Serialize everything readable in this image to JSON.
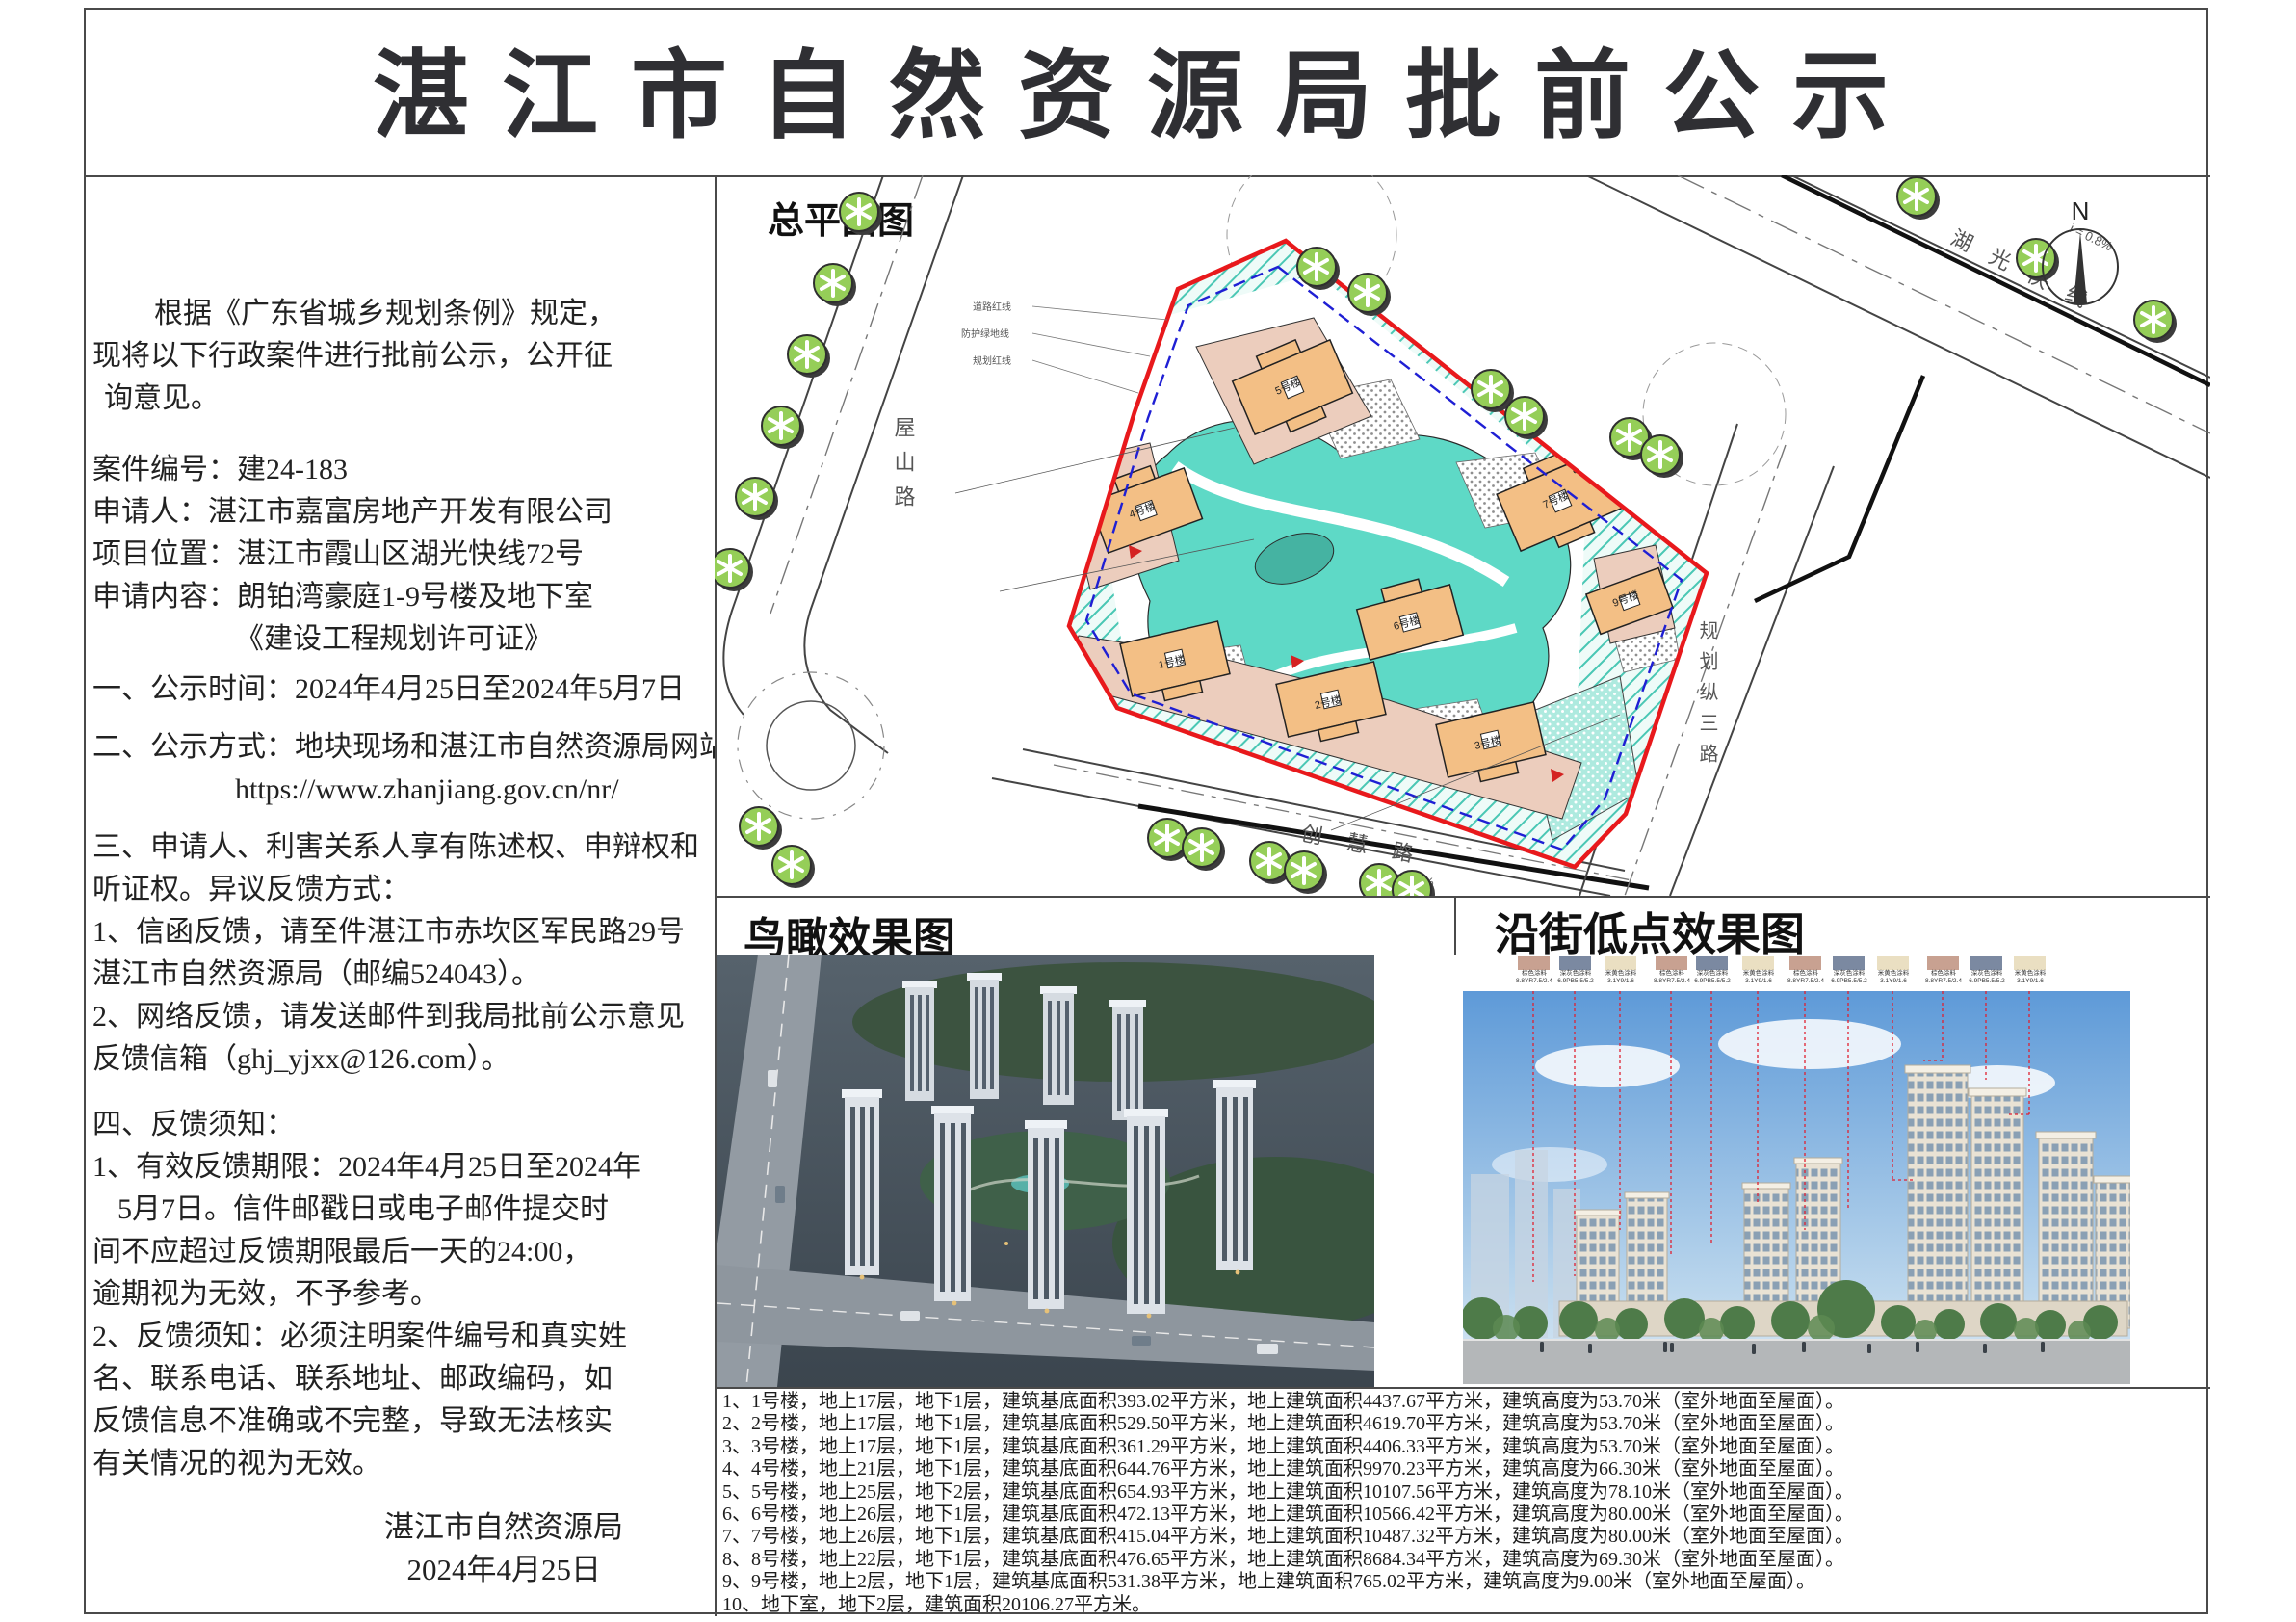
{
  "title": "湛江市自然资源局批前公示",
  "left_column": {
    "lines": [
      "根据《广东省城乡规划条例》规定，",
      "现将以下行政案件进行批前公示，公开征",
      "询意见。",
      "案件编号：建24-183",
      "申请人：湛江市嘉富房地产开发有限公司",
      "项目位置：湛江市霞山区湖光快线72号",
      "申请内容：朗铂湾豪庭1-9号楼及地下室",
      "《建设工程规划许可证》",
      "一、公示时间：2024年4月25日至2024年5月7日",
      "二、公示方式：地块现场和湛江市自然资源局网站",
      "https://www.zhanjiang.gov.cn/nr/",
      "三、申请人、利害关系人享有陈述权、申辩权和",
      "听证权。异议反馈方式：",
      "1、信函反馈，请至件湛江市赤坎区军民路29号",
      "湛江市自然资源局（邮编524043）。",
      "2、网络反馈，请发送邮件到我局批前公示意见",
      "反馈信箱（ghj_yjxx@126.com）。",
      "四、反馈须知：",
      "1、有效反馈期限：2024年4月25日至2024年",
      "5月7日。信件邮戳日或电子邮件提交时",
      "间不应超过反馈期限最后一天的24:00，",
      "逾期视为无效，不予参考。",
      "2、反馈须知：必须注明案件编号和真实姓",
      "名、联系电话、联系地址、邮政编码，如",
      "反馈信息不准确或不完整，导致无法核实",
      "有关情况的视为无效。"
    ],
    "sign_org": "湛江市自然资源局",
    "sign_date": "2024年4月25日"
  },
  "site_plan": {
    "label": "总平面图",
    "compass_n": "N",
    "roads": {
      "wushan": "屋山路",
      "huguang": "湖光快线",
      "guihua3": "规划纵三路",
      "chuanghui": "创慧路"
    },
    "slope1": "i = 0.8%",
    "slope2": "i ≤ 0.3%",
    "annotations": [
      "道路红线",
      "防护绿地线",
      "规划红线"
    ],
    "buildings": [
      "1号楼",
      "2号楼",
      "3号楼",
      "4号楼",
      "5号楼",
      "6号楼",
      "7号楼",
      "8号楼",
      "9号楼"
    ]
  },
  "bird_view": {
    "label": "鸟瞰效果图"
  },
  "street_view": {
    "label": "沿街低点效果图",
    "swatches": [
      {
        "name": "棕色涂料",
        "code": "8.8YR7.5/2.4"
      },
      {
        "name": "深灰色涂料",
        "code": "6.9PB5.5/5.2"
      },
      {
        "name": "米黄色涂料",
        "code": "3.1Y9/1.6"
      },
      {
        "name": "棕色涂料",
        "code": "8.8YR7.5/2.4"
      },
      {
        "name": "深灰色涂料",
        "code": "6.9PB5.5/5.2"
      },
      {
        "name": "米黄色涂料",
        "code": "3.1Y9/1.6"
      },
      {
        "name": "棕色涂料",
        "code": "8.8YR7.5/2.4"
      },
      {
        "name": "深灰色涂料",
        "code": "6.9PB5.5/5.2"
      },
      {
        "name": "米黄色涂料",
        "code": "3.1Y9/1.6"
      },
      {
        "name": "棕色涂料",
        "code": "8.8YR7.5/2.4"
      },
      {
        "name": "深灰色涂料",
        "code": "6.9PB5.5/5.2"
      },
      {
        "name": "米黄色涂料",
        "code": "3.1Y9/1.6"
      }
    ]
  },
  "notes": [
    "1、1号楼，地上17层，地下1层，建筑基底面积393.02平方米，地上建筑面积4437.67平方米，建筑高度为53.70米（室外地面至屋面）。",
    "2、2号楼，地上17层，地下1层，建筑基底面积529.50平方米，地上建筑面积4619.70平方米，建筑高度为53.70米（室外地面至屋面）。",
    "3、3号楼，地上17层，地下1层，建筑基底面积361.29平方米，地上建筑面积4406.33平方米，建筑高度为53.70米（室外地面至屋面）。",
    "4、4号楼，地上21层，地下1层，建筑基底面积644.76平方米，地上建筑面积9970.23平方米，建筑高度为66.30米（室外地面至屋面）。",
    "5、5号楼，地上25层，地下2层，建筑基底面积654.93平方米，地上建筑面积10107.56平方米，建筑高度为78.10米（室外地面至屋面）。",
    "6、6号楼，地上26层，地下1层，建筑基底面积472.13平方米，地上建筑面积10566.42平方米，建筑高度为80.00米（室外地面至屋面）。",
    "7、7号楼，地上26层，地下1层，建筑基底面积415.04平方米，地上建筑面积10487.32平方米，建筑高度为80.00米（室外地面至屋面）。",
    "8、8号楼，地上22层，地下1层，建筑基底面积476.65平方米，地上建筑面积8684.34平方米，建筑高度为69.30米（室外地面至屋面）。",
    "9、9号楼，地上2层，地下1层，建筑基底面积531.38平方米，地上建筑面积765.02平方米，建筑高度为9.00米（室外地面至屋面）。",
    "10、地下室，地下2层，建筑面积20106.27平方米。"
  ],
  "colors": {
    "red_boundary": "#e8191c",
    "blue_underground_line": "#1f1fd4",
    "green_buffer_hatch": "#49c7b4",
    "garden": "#5ed9c6",
    "building_fill": "#f3bf85",
    "podium_fill": "#eccdbd",
    "tree_green": "#95ce58",
    "swatch_brown": "#c8a191",
    "swatch_gray": "#7b89a1",
    "swatch_cream": "#eadfc2"
  }
}
